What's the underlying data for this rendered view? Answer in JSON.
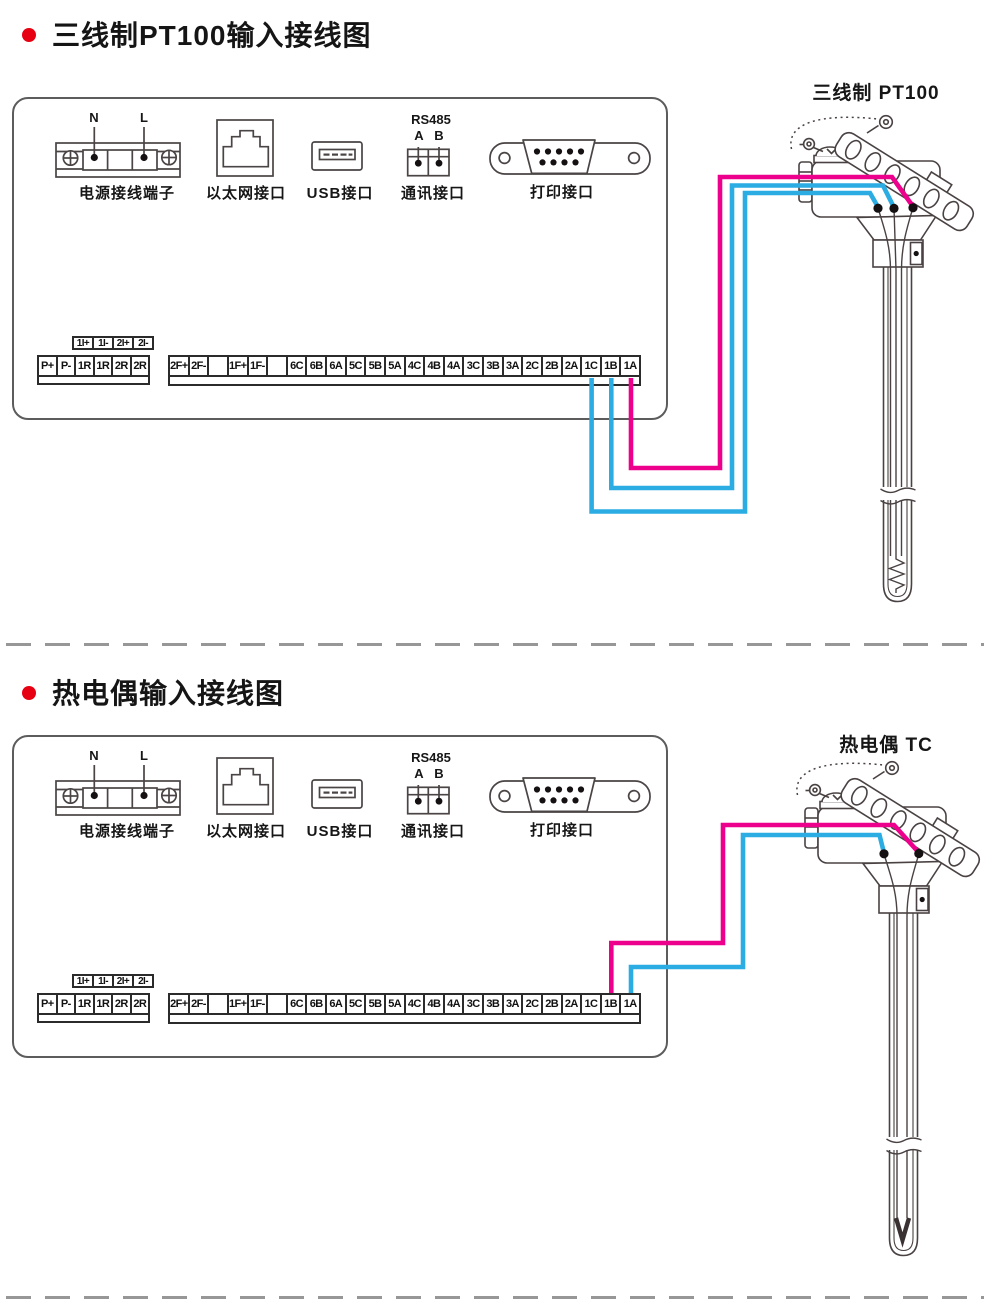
{
  "colors": {
    "wire_pink": "#ec008c",
    "wire_cyan": "#2bace2",
    "bullet_red": "#e60012"
  },
  "sections": [
    {
      "title": "三线制PT100输入接线图",
      "probe_label": "三线制 PT100",
      "ports": {
        "power": {
          "label": "电源接线端子",
          "pin_n": "N",
          "pin_l": "L"
        },
        "ethernet": {
          "label": "以太网接口"
        },
        "usb": {
          "label": "USB接口"
        },
        "comm": {
          "label": "通讯接口",
          "bus": "RS485",
          "pin_a": "A",
          "pin_b": "B"
        },
        "printer": {
          "label": "打印接口"
        }
      },
      "strips": {
        "aux": [
          "1I+",
          "1I-",
          "2I+",
          "2I-"
        ],
        "left": [
          "P+",
          "P-",
          "1R",
          "1R",
          "2R",
          "2R"
        ],
        "main": [
          "2F+",
          "2F-",
          "",
          "1F+",
          "1F-",
          "",
          "6C",
          "6B",
          "6A",
          "5C",
          "5B",
          "5A",
          "4C",
          "4B",
          "4A",
          "3C",
          "3B",
          "3A",
          "2C",
          "2B",
          "2A",
          "1C",
          "1B",
          "1A"
        ]
      }
    },
    {
      "title": "热电偶输入接线图",
      "probe_label": "热电偶 TC",
      "ports": {
        "power": {
          "label": "电源接线端子",
          "pin_n": "N",
          "pin_l": "L"
        },
        "ethernet": {
          "label": "以太网接口"
        },
        "usb": {
          "label": "USB接口"
        },
        "comm": {
          "label": "通讯接口",
          "bus": "RS485",
          "pin_a": "A",
          "pin_b": "B"
        },
        "printer": {
          "label": "打印接口"
        }
      },
      "strips": {
        "aux": [
          "1I+",
          "1I-",
          "2I+",
          "2I-"
        ],
        "left": [
          "P+",
          "P-",
          "1R",
          "1R",
          "2R",
          "2R"
        ],
        "main": [
          "2F+",
          "2F-",
          "",
          "1F+",
          "1F-",
          "",
          "6C",
          "6B",
          "6A",
          "5C",
          "5B",
          "5A",
          "4C",
          "4B",
          "4A",
          "3C",
          "3B",
          "3A",
          "2C",
          "2B",
          "2A",
          "1C",
          "1B",
          "1A"
        ]
      }
    }
  ]
}
